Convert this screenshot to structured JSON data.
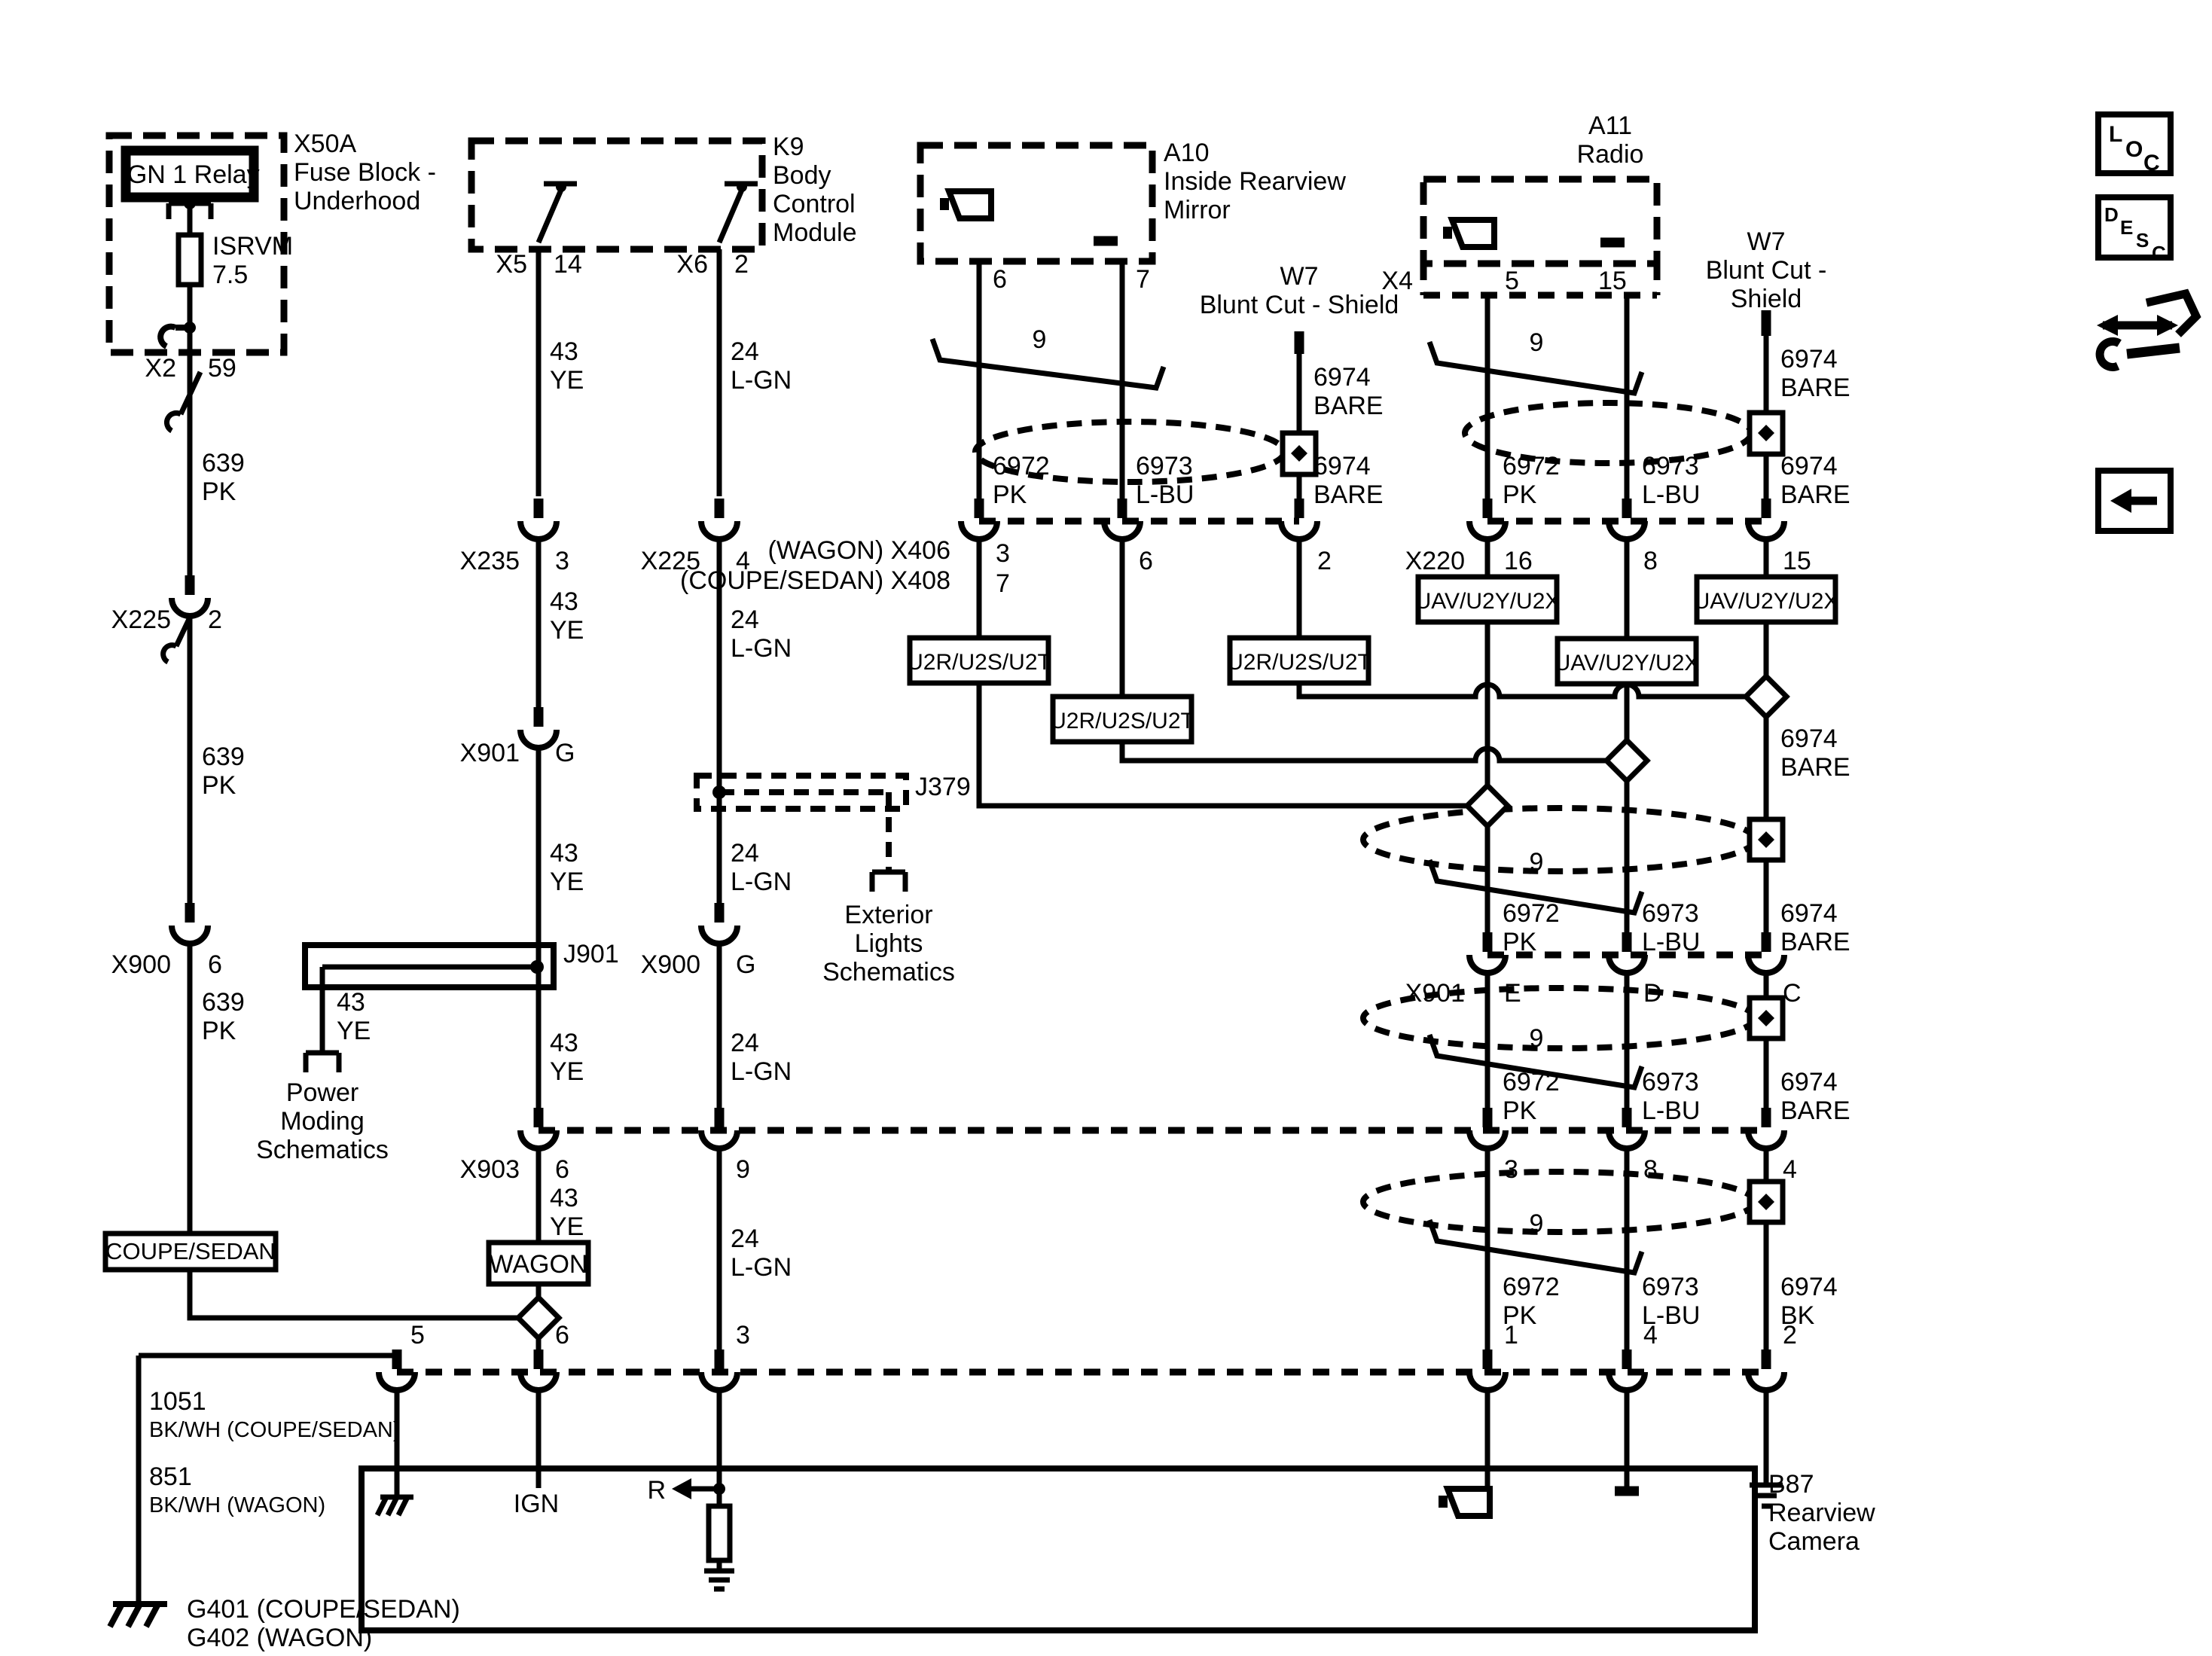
{
  "icons": {
    "loc": [
      "L",
      "O",
      "C"
    ],
    "desc": [
      "D",
      "E",
      "S",
      "C"
    ]
  },
  "components": {
    "x50a": {
      "id": "X50A",
      "l1": "Fuse Block -",
      "l2": "Underhood",
      "relay": "IGN 1 Relay",
      "fuse_name": "ISRVM",
      "fuse_rating": "7.5"
    },
    "k9": {
      "id": "K9",
      "l1": "Body",
      "l2": "Control",
      "l3": "Module"
    },
    "a10": {
      "id": "A10",
      "l1": "Inside Rearview",
      "l2": "Mirror"
    },
    "a11": {
      "id": "A11",
      "l1": "Radio"
    },
    "w7a": {
      "id": "W7",
      "l1": "Blunt Cut - Shield"
    },
    "w7b": {
      "id": "W7",
      "l1": "Blunt Cut -",
      "l2": "Shield"
    },
    "b87": {
      "id": "B87",
      "l1": "Rearview",
      "l2": "Camera",
      "ign": "IGN",
      "r": "R"
    },
    "j901": "J901",
    "j379": "J379",
    "power_moding": [
      "Power",
      "Moding",
      "Schematics"
    ],
    "exterior_lights": [
      "Exterior",
      "Lights",
      "Schematics"
    ],
    "coupe_sedan": "COUPE/SEDAN",
    "wagon": "WAGON",
    "g401": "G401  (COUPE/SEDAN)",
    "g402": "G402   (WAGON)",
    "u2r": "U2R/U2S/U2T",
    "uav": "UAV/U2Y/U2X",
    "twist": "9"
  },
  "wires": {
    "n639": "639",
    "pk": "PK",
    "n43": "43",
    "ye": "YE",
    "n24": "24",
    "lgn": "L-GN",
    "n6972": "6972",
    "n6973": "6973",
    "n6974": "6974",
    "lbu": "L-BU",
    "bare": "BARE",
    "bk": "BK",
    "n1051": "1051",
    "cs1051": "BK/WH  (COUPE/SEDAN)",
    "n851": "851",
    "w851": "BK/WH  (WAGON)"
  },
  "pins": {
    "p1": "1",
    "p2": "2",
    "p3": "3",
    "p4": "4",
    "p5": "5",
    "p6": "6",
    "p7": "7",
    "p8": "8",
    "p9": "9",
    "p14": "14",
    "p15": "15",
    "p16": "16",
    "p59": "59",
    "pE": "E",
    "pD": "D",
    "pC": "C",
    "pG": "G"
  },
  "connectors": {
    "x2": "X2",
    "x4": "X4",
    "x5": "X5",
    "x6": "X6",
    "x220": "X220",
    "x225": "X225",
    "x235": "X235",
    "x900": "X900",
    "x901": "X901",
    "x903": "X903",
    "x406": "(WAGON)  X406",
    "x408": "(COUPE/SEDAN)  X408"
  }
}
